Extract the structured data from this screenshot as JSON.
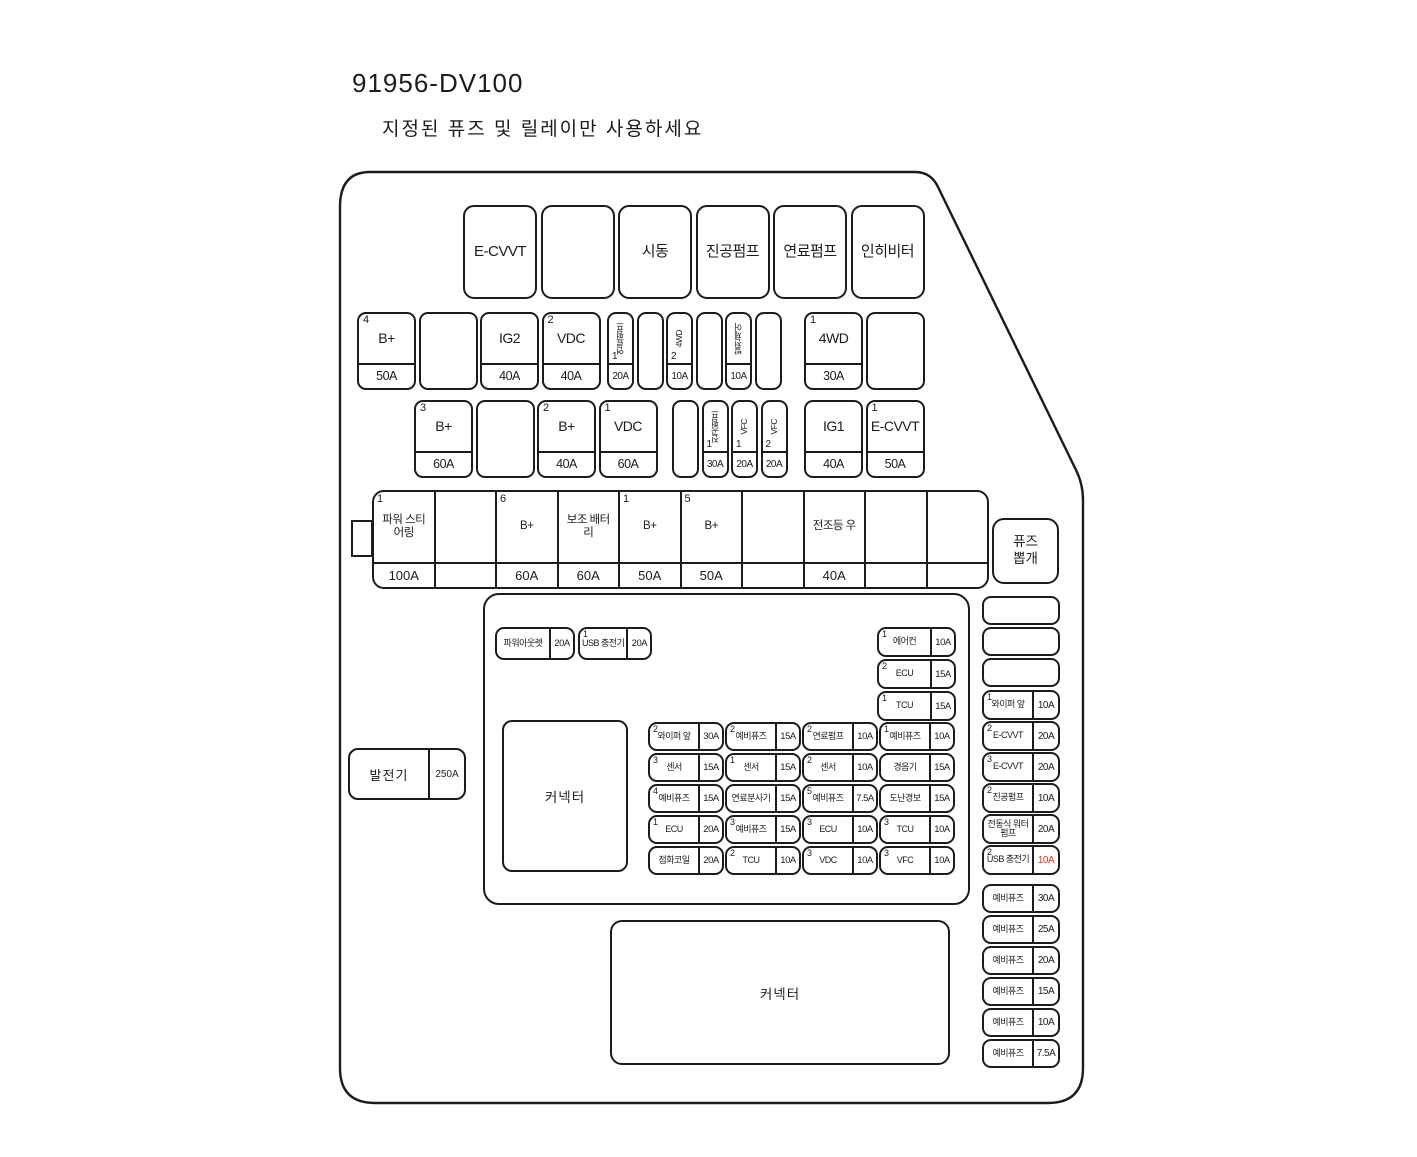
{
  "title": "91956-DV100",
  "subtitle": "지정된 퓨즈 및 릴레이만 사용하세요",
  "colors": {
    "line": "#1c1c1c",
    "red_amp": "#cf3a1e"
  },
  "relay_row": [
    {
      "label": "E-CVVT"
    },
    {
      "blank": true
    },
    {
      "label": "시동"
    },
    {
      "label": "진공펌프"
    },
    {
      "label": "연료펌프"
    },
    {
      "label": "인히비터"
    }
  ],
  "row2_left": [
    {
      "num": "4",
      "label": "B+",
      "amp": "50A"
    },
    {
      "blank": true
    },
    {
      "label": "IG2",
      "amp": "40A"
    },
    {
      "num": "2",
      "label": "VDC",
      "amp": "40A"
    }
  ],
  "row2_mid": [
    {
      "num": "1",
      "label": "연료펌프",
      "amp": "20A",
      "vertical": true
    },
    {
      "blank": true
    },
    {
      "num": "2",
      "label": "4WD",
      "amp": "10A",
      "vertical": true
    },
    {
      "blank": true
    },
    {
      "label": "발전제어",
      "amp": "10A",
      "vertical": true
    },
    {
      "blank": true
    }
  ],
  "row2_right": [
    {
      "num": "1",
      "label": "4WD",
      "amp": "30A"
    },
    {
      "blank": true
    }
  ],
  "row3_left": [
    {
      "num": "3",
      "label": "B+",
      "amp": "60A"
    },
    {
      "blank": true
    },
    {
      "num": "2",
      "label": "B+",
      "amp": "40A"
    },
    {
      "num": "1",
      "label": "VDC",
      "amp": "60A"
    }
  ],
  "row3_mid": [
    {
      "blank": true
    },
    {
      "num": "1",
      "label": "진공펌프",
      "amp": "30A",
      "vertical": true
    },
    {
      "num": "1",
      "label": "VFC",
      "amp": "20A",
      "vertical": true
    },
    {
      "num": "2",
      "label": "VFC",
      "amp": "20A",
      "vertical": true
    }
  ],
  "row3_right": [
    {
      "label": "IG1",
      "amp": "40A"
    },
    {
      "num": "1",
      "label": "E-CVVT",
      "amp": "50A"
    }
  ],
  "row4_cells": [
    {
      "num": "1",
      "label": "파워 스티어링",
      "amp": "100A"
    },
    {
      "blank": true
    },
    {
      "num": "6",
      "label": "B+",
      "amp": "60A"
    },
    {
      "label": "보조 배터리",
      "amp": "60A"
    },
    {
      "num": "1",
      "label": "B+",
      "amp": "50A"
    },
    {
      "num": "5",
      "label": "B+",
      "amp": "50A"
    },
    {
      "blank": true
    },
    {
      "label": "전조등 우",
      "amp": "40A"
    },
    {
      "blank": true
    },
    {
      "blank": true
    }
  ],
  "fuse_puller": {
    "line1": "퓨즈",
    "line2": "뽑개"
  },
  "alternator": {
    "label": "발전기",
    "amp": "250A"
  },
  "center_top": [
    {
      "label": "파워아웃렛",
      "amp": "20A"
    },
    {
      "num": "1",
      "label": "USB 충전기",
      "amp": "20A"
    }
  ],
  "center_right": [
    {
      "num": "1",
      "label": "에어컨",
      "amp": "10A"
    },
    {
      "num": "2",
      "label": "ECU",
      "amp": "15A"
    },
    {
      "num": "1",
      "label": "TCU",
      "amp": "15A"
    }
  ],
  "grid_col1": [
    {
      "num": "2",
      "label": "와이퍼 앞",
      "amp": "30A"
    },
    {
      "num": "3",
      "label": "센서",
      "amp": "15A"
    },
    {
      "num": "4",
      "label": "예비퓨즈",
      "amp": "15A"
    },
    {
      "num": "1",
      "label": "ECU",
      "amp": "20A"
    },
    {
      "label": "점화코일",
      "amp": "20A"
    }
  ],
  "grid_col2": [
    {
      "num": "2",
      "label": "예비퓨즈",
      "amp": "15A"
    },
    {
      "num": "1",
      "label": "센서",
      "amp": "15A"
    },
    {
      "label": "연료분사기",
      "amp": "15A"
    },
    {
      "num": "3",
      "label": "예비퓨즈",
      "amp": "15A"
    },
    {
      "num": "2",
      "label": "TCU",
      "amp": "10A"
    }
  ],
  "grid_col3": [
    {
      "num": "2",
      "label": "연료펌프",
      "amp": "10A"
    },
    {
      "num": "2",
      "label": "센서",
      "amp": "10A"
    },
    {
      "num": "5",
      "label": "예비퓨즈",
      "amp": "7.5A"
    },
    {
      "num": "3",
      "label": "ECU",
      "amp": "10A"
    },
    {
      "num": "3",
      "label": "VDC",
      "amp": "10A"
    }
  ],
  "grid_col4": [
    {
      "num": "1",
      "label": "예비퓨즈",
      "amp": "10A"
    },
    {
      "label": "경음기",
      "amp": "15A"
    },
    {
      "label": "도난경보",
      "amp": "15A"
    },
    {
      "num": "3",
      "label": "TCU",
      "amp": "10A"
    },
    {
      "num": "3",
      "label": "VFC",
      "amp": "10A"
    }
  ],
  "connector1_label": "커넥터",
  "connector2_label": "커넥터",
  "right_panel_empty": [
    {
      "blank": true
    },
    {
      "blank": true
    },
    {
      "blank": true
    }
  ],
  "right_panel": [
    {
      "num": "1",
      "label": "와이퍼 앞",
      "amp": "10A"
    },
    {
      "num": "2",
      "label": "E-CVVT",
      "amp": "20A"
    },
    {
      "num": "3",
      "label": "E-CVVT",
      "amp": "20A"
    },
    {
      "num": "2",
      "label": "진공펌프",
      "amp": "10A"
    },
    {
      "label": "전동식 워터펌프",
      "amp": "20A"
    },
    {
      "num": "2",
      "label": "USB 충전기",
      "amp": "10A",
      "red": true
    }
  ],
  "spares": [
    {
      "label": "예비퓨즈",
      "amp": "30A"
    },
    {
      "label": "예비퓨즈",
      "amp": "25A"
    },
    {
      "label": "예비퓨즈",
      "amp": "20A"
    },
    {
      "label": "예비퓨즈",
      "amp": "15A"
    },
    {
      "label": "예비퓨즈",
      "amp": "10A"
    },
    {
      "label": "예비퓨즈",
      "amp": "7.5A"
    }
  ]
}
